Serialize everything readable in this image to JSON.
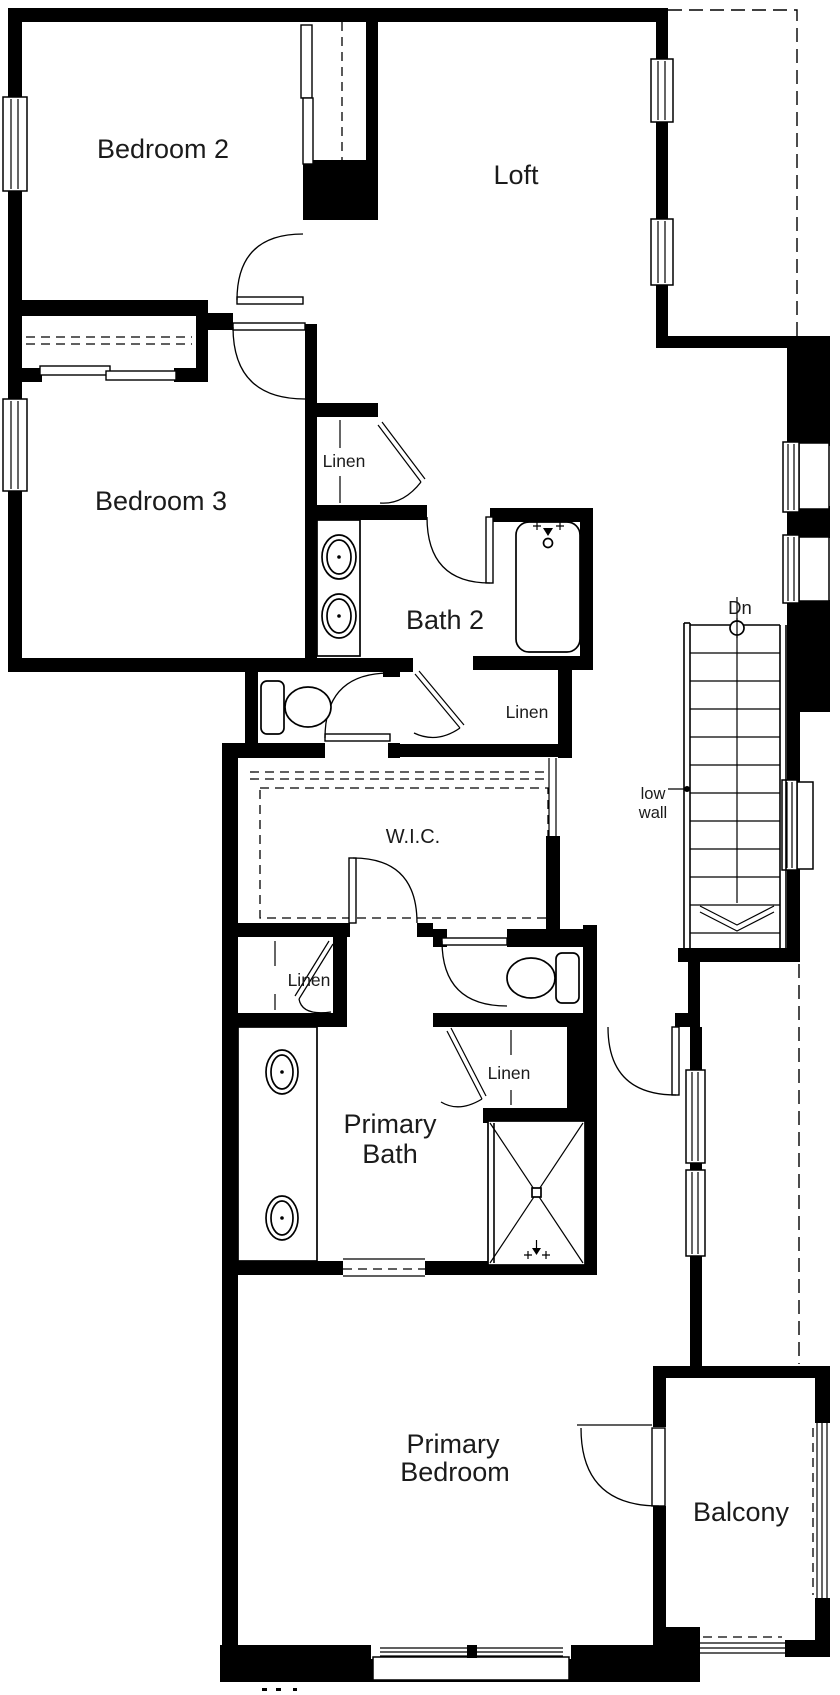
{
  "labels": {
    "bedroom2": "Bedroom 2",
    "loft": "Loft",
    "bedroom3": "Bedroom 3",
    "bath2": "Bath 2",
    "wic": "W.I.C.",
    "linen": "Linen",
    "primary_bath_line1": "Primary",
    "primary_bath_line2": "Bath",
    "primary_bedroom_line1": "Primary",
    "primary_bedroom_line2": "Bedroom",
    "balcony": "Balcony",
    "stairs_direction": "Dn",
    "stairs_note_line1": "low",
    "stairs_note_line2": "wall"
  },
  "colors": {
    "wall": "#000000",
    "background": "#ffffff",
    "text": "#1b1b1b"
  }
}
